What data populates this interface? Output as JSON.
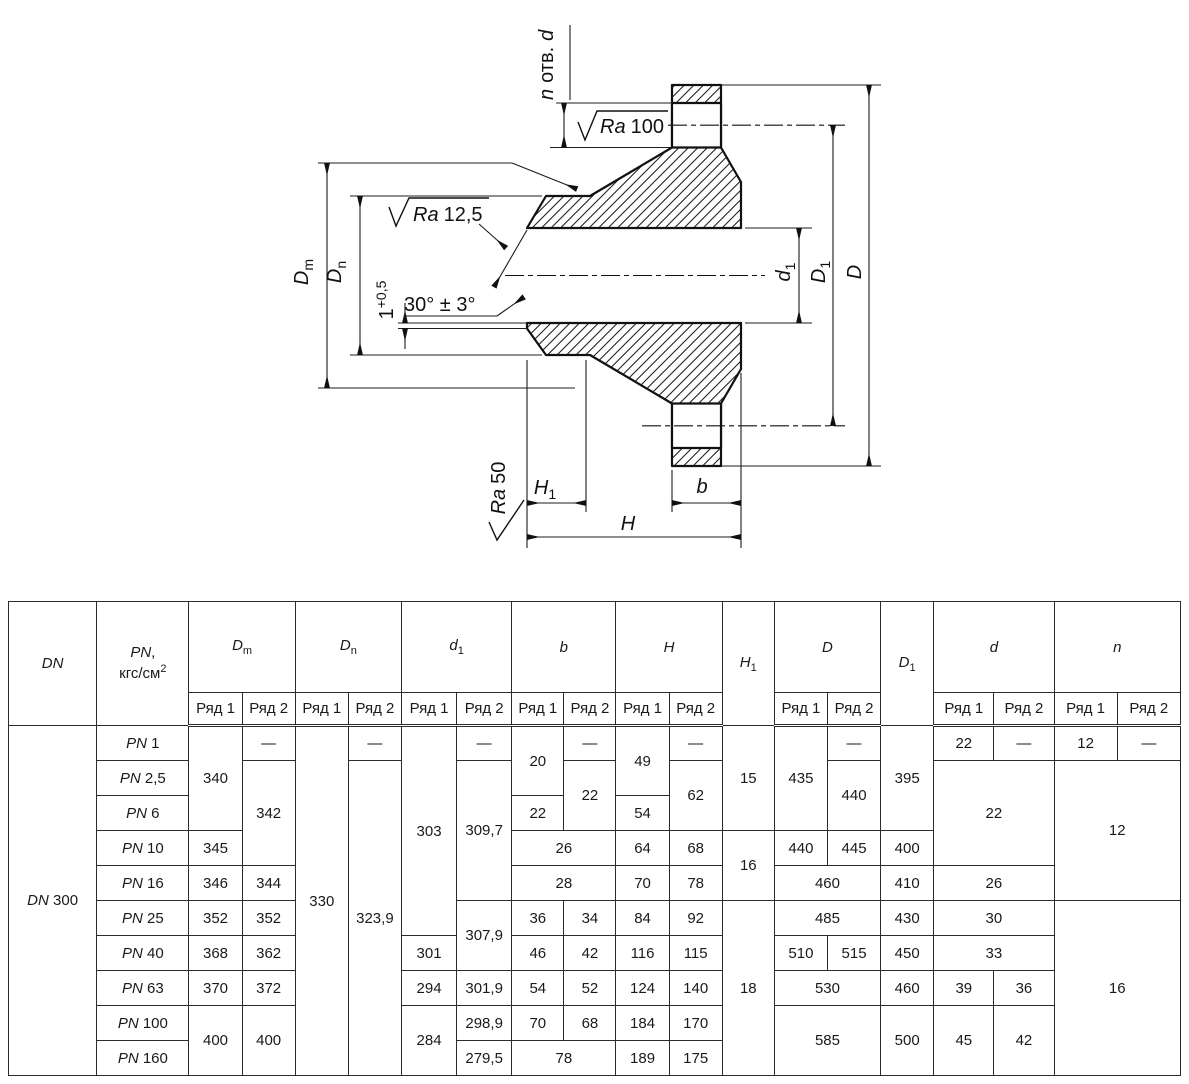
{
  "drawing": {
    "n_holes": {
      "pre": "n",
      "mid": "отв.",
      "post": "d"
    },
    "ra_top": {
      "it": "Ra",
      "val": "100"
    },
    "ra_hub": {
      "it": "Ra",
      "val": "12,5"
    },
    "ra_face": {
      "it": "Ra",
      "val": "50"
    },
    "angle": "30° ± 3°",
    "land": {
      "base": "1",
      "sup": "+0,5"
    },
    "labels": {
      "Dm": {
        "b": "D",
        "s": "m"
      },
      "Dn": {
        "b": "D",
        "s": "n"
      },
      "d1": {
        "b": "d",
        "s": "1"
      },
      "D1": {
        "b": "D",
        "s": "1"
      },
      "D": {
        "b": "D",
        "s": ""
      },
      "H1": {
        "b": "H",
        "s": "1"
      },
      "H": {
        "b": "H",
        "s": ""
      },
      "b": {
        "b": "b",
        "s": ""
      }
    }
  },
  "table": {
    "header": {
      "dn": "DN",
      "pn_it": "PN",
      "pn_comma": ",",
      "pn_unit": "кгс/см",
      "pn_sup": "2",
      "row1": "Ряд 1",
      "row2": "Ряд 2",
      "groups": [
        {
          "b": "D",
          "s": "m"
        },
        {
          "b": "D",
          "s": "n"
        },
        {
          "b": "d",
          "s": "1"
        },
        {
          "b": "b",
          "s": ""
        },
        {
          "b": "H",
          "s": ""
        },
        {
          "b": "H",
          "s": "1"
        },
        {
          "b": "D",
          "s": ""
        },
        {
          "b": "D",
          "s": "1"
        },
        {
          "b": "d",
          "s": ""
        },
        {
          "b": "n",
          "s": ""
        }
      ]
    },
    "dn_it": "DN",
    "dn_num": "300",
    "pn_prefix": "PN",
    "rows": [
      {
        "pn": "1",
        "cells": [
          "340",
          "—",
          "330",
          "—",
          "303",
          "—",
          "20",
          "—",
          "49",
          "—",
          "15",
          "435",
          "—",
          "395",
          "22",
          "—",
          "12",
          "—"
        ]
      },
      {
        "pn": "2,5",
        "cells": [
          "342",
          "323,9",
          "309,7",
          "22",
          "62",
          "440",
          "22",
          "12"
        ]
      },
      {
        "pn": "6",
        "cells": [
          "22",
          "54"
        ]
      },
      {
        "pn": "10",
        "cells": [
          "345",
          "26",
          "64",
          "68",
          "16",
          "440",
          "445",
          "400"
        ]
      },
      {
        "pn": "16",
        "cells": [
          "346",
          "344",
          "28",
          "70",
          "78",
          "460",
          "410",
          "26"
        ]
      },
      {
        "pn": "25",
        "cells": [
          "352",
          "352",
          "307,9",
          "36",
          "34",
          "84",
          "92",
          "18",
          "485",
          "430",
          "30",
          "16"
        ]
      },
      {
        "pn": "40",
        "cells": [
          "368",
          "362",
          "301",
          "46",
          "42",
          "116",
          "115",
          "510",
          "515",
          "450",
          "33"
        ]
      },
      {
        "pn": "63",
        "cells": [
          "370",
          "372",
          "294",
          "301,9",
          "54",
          "52",
          "124",
          "140",
          "530",
          "460",
          "39",
          "36"
        ]
      },
      {
        "pn": "100",
        "cells": [
          "400",
          "400",
          "284",
          "298,9",
          "70",
          "68",
          "184",
          "170",
          "585",
          "500",
          "45",
          "42"
        ]
      },
      {
        "pn": "160",
        "cells": [
          "279,5",
          "78",
          "189",
          "175"
        ]
      }
    ]
  }
}
